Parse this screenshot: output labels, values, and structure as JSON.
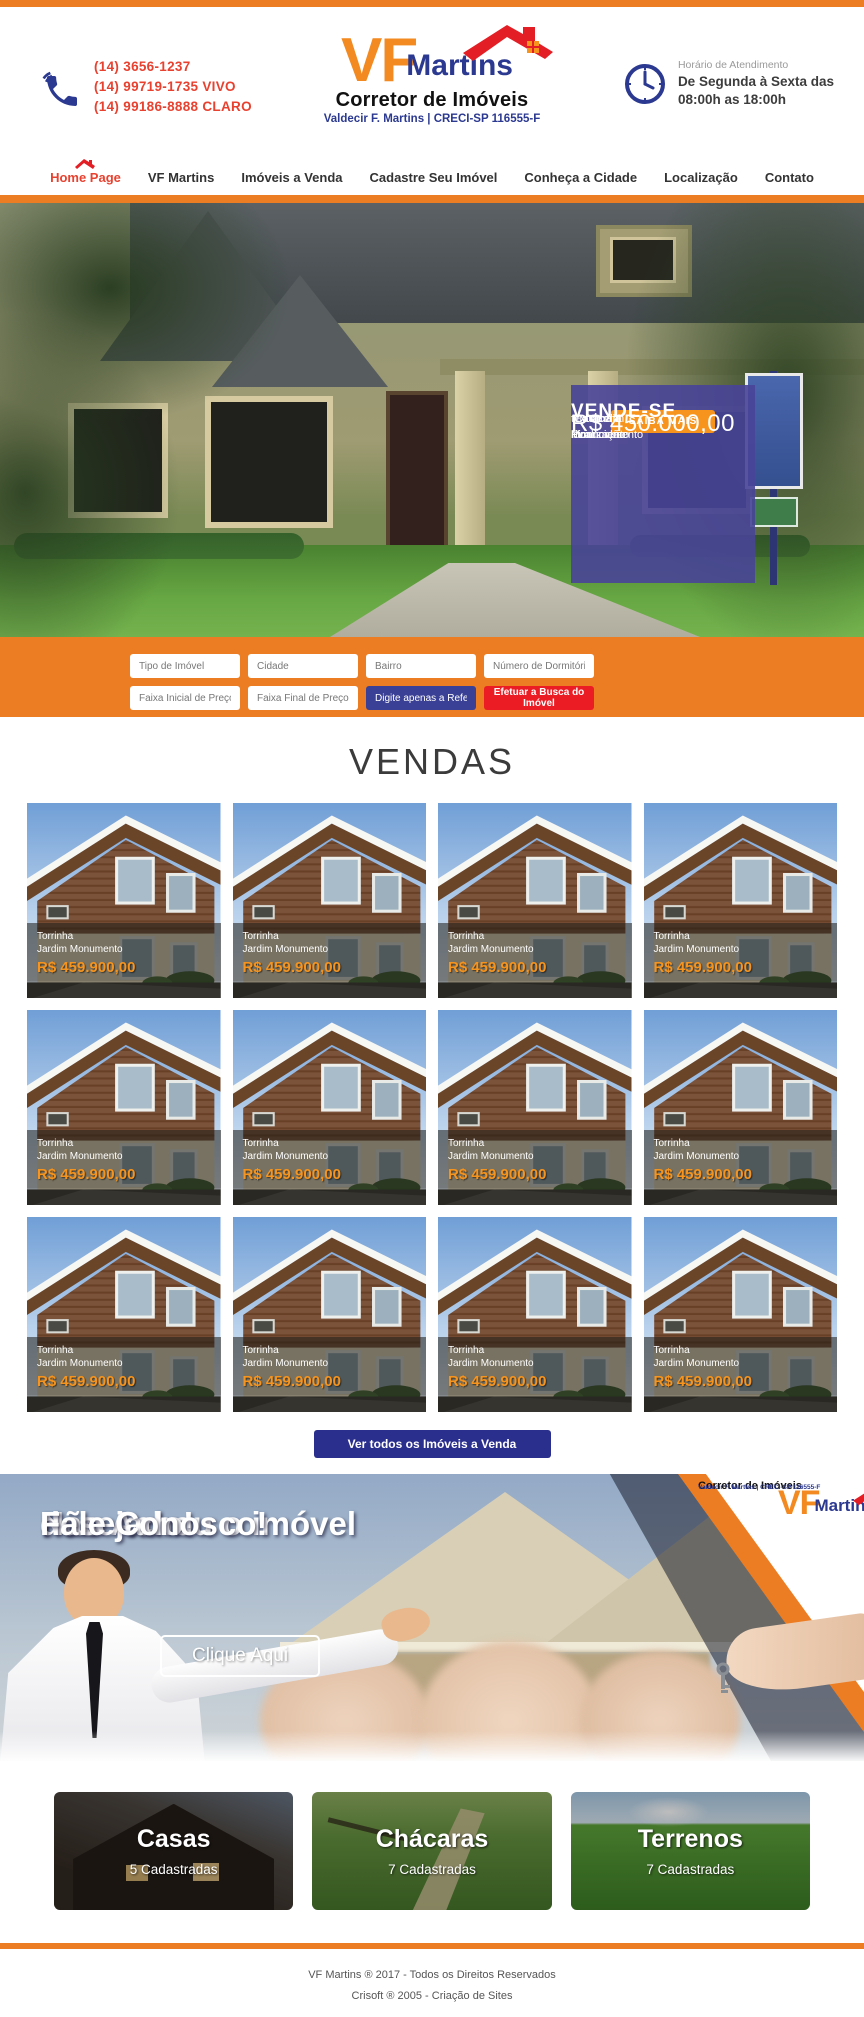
{
  "colors": {
    "orange": "#ED7D23",
    "blue": "#2B3990",
    "red": "#E8412F",
    "indigo_button": "#2A2F8E",
    "reference_input_bg": "#3A4095",
    "search_submit_red": "#EC1C24",
    "price_orange": "#F7941D",
    "sale_box_purple": "#484499"
  },
  "icons": {
    "phone": "handset-glyph",
    "clock": "clock-glyph",
    "home_roof": "red-roof-glyph",
    "logo_roof": "red-house-roof-glyph"
  },
  "header": {
    "phones": [
      "(14) 3656-1237",
      "(14) 99719-1735 VIVO",
      "(14) 99186-8888 CLARO"
    ],
    "logo": {
      "vf": "VF",
      "martins": "Martins",
      "subtitle": "Corretor de Imóveis",
      "creci": "Valdecir F. Martins | CRECI-SP 116555-F"
    },
    "schedule": {
      "label": "Horário de Atendimento",
      "line1": "De Segunda à Sexta das",
      "line2": "08:00h as 18:00h"
    }
  },
  "nav": {
    "items": [
      {
        "label": "Home Page",
        "active": true
      },
      {
        "label": "VF Martins",
        "active": false
      },
      {
        "label": "Imóveis a Venda",
        "active": false
      },
      {
        "label": "Cadastre Seu Imóvel",
        "active": false
      },
      {
        "label": "Conheça a Cidade",
        "active": false
      },
      {
        "label": "Localização",
        "active": false
      },
      {
        "label": "Contato",
        "active": false
      }
    ]
  },
  "hero": {
    "sale_box": {
      "title": "VENDE-SE",
      "lines": [
        "Casa em Piracicaba",
        "no Jardim Monumento",
        "ótima localização",
        "aceita Financiamento",
        "texto livre"
      ],
      "price": "R$ 450.000,00",
      "button": "SAIBA MAIS"
    }
  },
  "search": {
    "fields": [
      "Tipo de Imóvel",
      "Cidade",
      "Bairro",
      "Número de Dormitórios",
      "Faixa Inicial de Preço",
      "Faixa Final de Preço"
    ],
    "reference_placeholder": "Digite apenas a Referência",
    "submit_button": "Efetuar a Busca do Imóvel"
  },
  "vendas": {
    "title": "VENDAS",
    "see_all_button": "Ver todos os Imóveis a Venda",
    "listings": [
      {
        "city": "Torrinha",
        "neighborhood": "Jardim Monumento",
        "price": "R$ 459.900,00"
      },
      {
        "city": "Torrinha",
        "neighborhood": "Jardim Monumento",
        "price": "R$ 459.900,00"
      },
      {
        "city": "Torrinha",
        "neighborhood": "Jardim Monumento",
        "price": "R$ 459.900,00"
      },
      {
        "city": "Torrinha",
        "neighborhood": "Jardim Monumento",
        "price": "R$ 459.900,00"
      },
      {
        "city": "Torrinha",
        "neighborhood": "Jardim Monumento",
        "price": "R$ 459.900,00"
      },
      {
        "city": "Torrinha",
        "neighborhood": "Jardim Monumento",
        "price": "R$ 459.900,00"
      },
      {
        "city": "Torrinha",
        "neighborhood": "Jardim Monumento",
        "price": "R$ 459.900,00"
      },
      {
        "city": "Torrinha",
        "neighborhood": "Jardim Monumento",
        "price": "R$ 459.900,00"
      },
      {
        "city": "Torrinha",
        "neighborhood": "Jardim Monumento",
        "price": "R$ 459.900,00"
      },
      {
        "city": "Torrinha",
        "neighborhood": "Jardim Monumento",
        "price": "R$ 459.900,00"
      },
      {
        "city": "Torrinha",
        "neighborhood": "Jardim Monumento",
        "price": "R$ 459.900,00"
      },
      {
        "city": "Torrinha",
        "neighborhood": "Jardim Monumento",
        "price": "R$ 459.900,00"
      }
    ]
  },
  "banner": {
    "line1": "Não Achou o imóvel",
    "line2": "desejado!",
    "line3": "Fale Conosco!",
    "button": "Clique Aqui"
  },
  "categories": [
    {
      "title": "Casas",
      "count": "5 Cadastradas"
    },
    {
      "title": "Chácaras",
      "count": "7 Cadastradas"
    },
    {
      "title": "Terrenos",
      "count": "7 Cadastradas"
    }
  ],
  "footer": {
    "line1": "VF Martins ® 2017 - Todos os Direitos Reservados",
    "line2": "Crisoft ® 2005 - Criação de Sites"
  }
}
